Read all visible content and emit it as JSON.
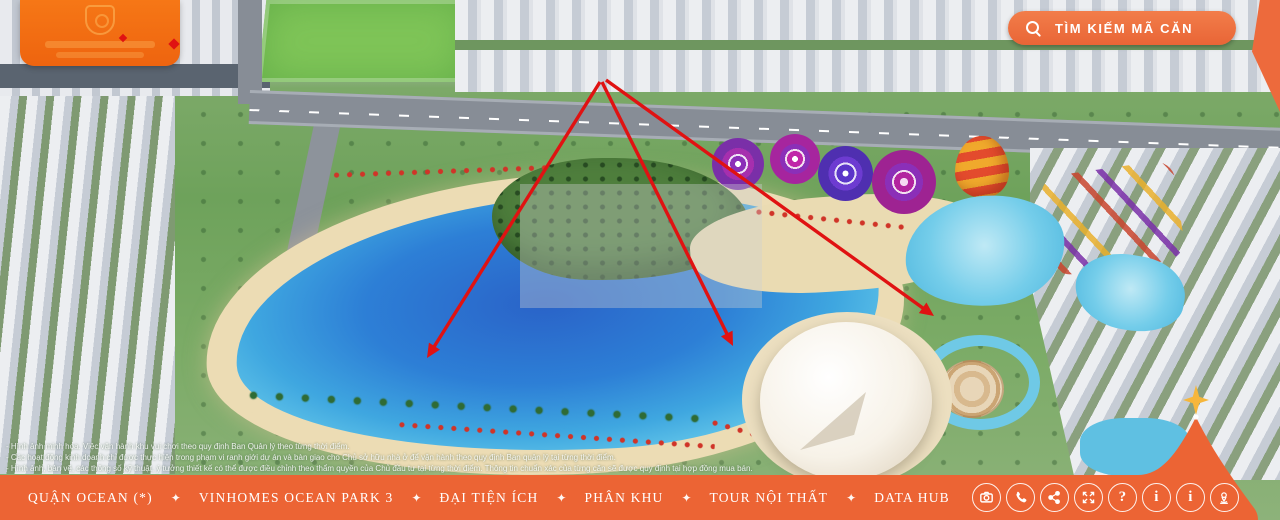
{
  "header": {
    "search_label": "TÌM KIẾM MÃ CĂN"
  },
  "nav": {
    "separator": "✦",
    "items": [
      {
        "label": "QUẬN OCEAN (*)"
      },
      {
        "label": "VINHOMES OCEAN PARK 3"
      },
      {
        "label": "ĐẠI TIỆN ÍCH"
      },
      {
        "label": "PHÂN KHU"
      },
      {
        "label": "TOUR NỘI THẤT"
      },
      {
        "label": "DATA HUB"
      }
    ],
    "icon_buttons": [
      "vr-360",
      "phone",
      "share",
      "fullscreen",
      "help",
      "info",
      "info-alt",
      "location"
    ],
    "help_glyph": "?",
    "info_glyph": "i",
    "info_alt_glyph": "i"
  },
  "annotation": {
    "color": "#e01212",
    "arrows": [
      {
        "from": [
          600,
          82
        ],
        "to": [
          427,
          358
        ]
      },
      {
        "from": [
          602,
          82
        ],
        "to": [
          733,
          346
        ]
      },
      {
        "from": [
          606,
          80
        ],
        "to": [
          934,
          316
        ]
      }
    ]
  },
  "disclaimer": {
    "lines": [
      "- Hình ảnh minh họa. Việc vận hành khu vui chơi theo quy định Ban Quản lý theo từng thời điểm.",
      "- Các hoạt động kinh doanh chỉ được thực hiện trong phạm vi ranh giới dự án và bàn giao cho Chủ sở hữu nhà ở để vận hành theo quy định Ban quản lý tại từng thời điểm.",
      "- Hình ảnh, bản vẽ, các thông số kỹ thuật, ý tưởng thiết kế có thể được điều chỉnh theo thẩm quyền của Chủ đầu tư tại từng thời điểm. Thông tin chuẩn xác của từng căn sẽ được quy định tại hợp đồng mua bán."
    ]
  },
  "colors": {
    "bar": "#ec6434",
    "search_pill": "#ee7140",
    "logo": "#f4700f",
    "star": "#f6b63b",
    "arrow": "#e01212"
  }
}
